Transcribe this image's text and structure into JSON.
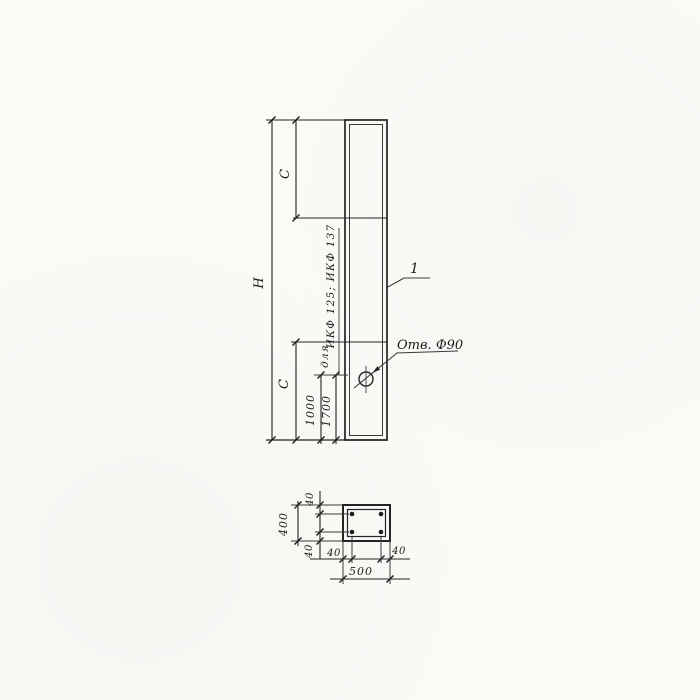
{
  "drawing": {
    "kind": "column technical drawing (elevation + cross-section)",
    "ink_color": "#242424",
    "paper_color": "#fbfaf7"
  },
  "elevation": {
    "overall_height_label": "H",
    "top_segment_label": "C",
    "bottom_segment_label": "C",
    "hole_offset_primary": "1000",
    "hole_offset_alt": "1700",
    "note_prefix": "для",
    "note_models": "ИКФ 125; ИКФ 137",
    "hole_callout": "Отв. Ф90",
    "item_number": "1"
  },
  "section": {
    "width_label": "500",
    "height_label": "400",
    "cover_top_label": "40",
    "cover_bottom_label": "40",
    "cover_left_label": "40",
    "cover_right_label": "40"
  }
}
